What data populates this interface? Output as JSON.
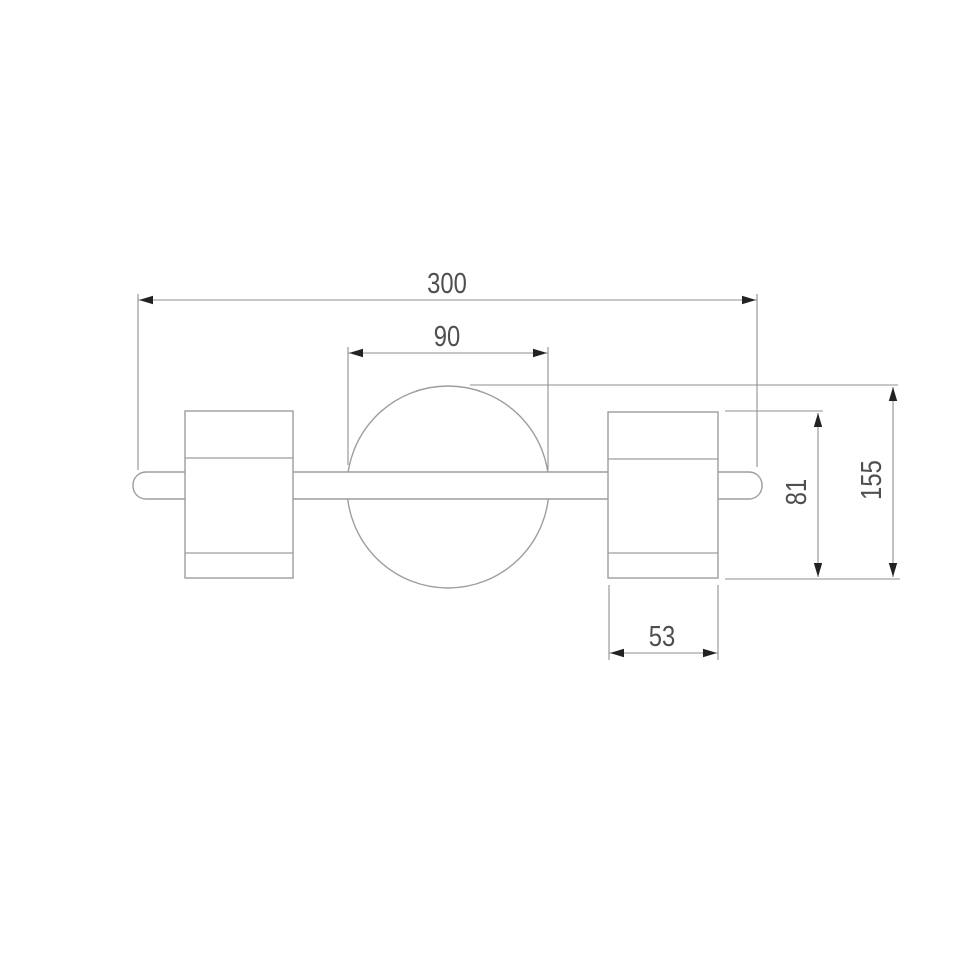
{
  "diagram": {
    "type": "technical-dimension-drawing",
    "subject": "two-spot wall light with central sphere, front elevation",
    "colors": {
      "background": "#ffffff",
      "outline": "#9d9d9d",
      "dimension_line": "#8f8f8f",
      "arrow": "#222222",
      "text": "#4f4f4f"
    },
    "dimensions": {
      "overall_width": {
        "label": "300",
        "orientation": "horizontal",
        "measures": "overall width of mounting bar"
      },
      "sphere_diameter": {
        "label": "90",
        "orientation": "horizontal",
        "measures": "central sphere diameter"
      },
      "spot_height": {
        "label": "81",
        "orientation": "vertical",
        "measures": "spot cylinder height"
      },
      "overall_height": {
        "label": "155",
        "orientation": "vertical",
        "measures": "overall height from sphere top to cylinder bottom"
      },
      "spot_width": {
        "label": "53",
        "orientation": "horizontal",
        "measures": "spot cylinder width"
      }
    }
  }
}
